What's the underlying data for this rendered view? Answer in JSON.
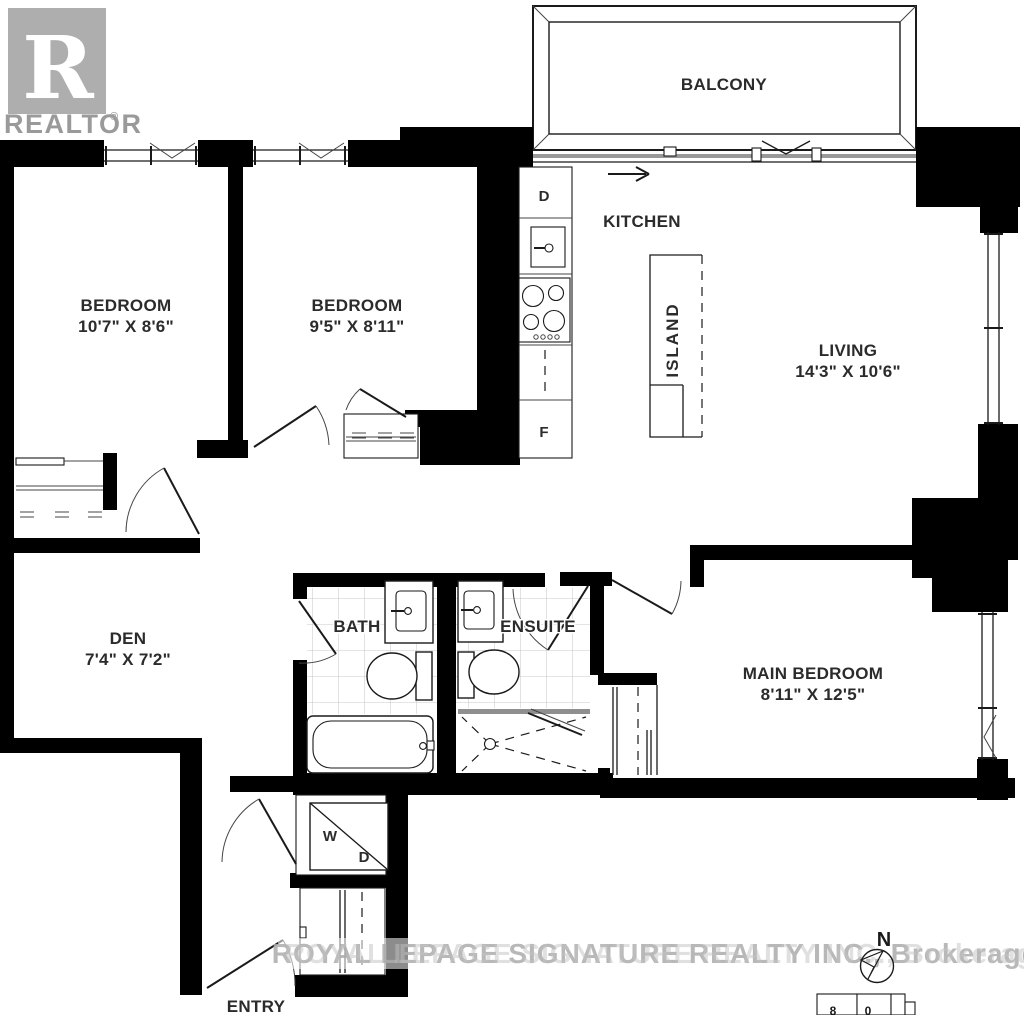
{
  "branding": {
    "realtor_logo": {
      "letter": "R",
      "label": "REALTOR",
      "registered": "®",
      "color": "#aeaeae"
    },
    "brokerage_watermark": "ROYAL LEPAGE SIGNATURE REALTY INC., Brokerage"
  },
  "rooms": {
    "balcony": {
      "name": "BALCONY"
    },
    "kitchen": {
      "name": "KITCHEN"
    },
    "island": {
      "name": "ISLAND"
    },
    "living": {
      "name": "LIVING",
      "dimensions": "14'3\" X 10'6\""
    },
    "bedroom_1": {
      "name": "BEDROOM",
      "dimensions": "10'7\" X 8'6\""
    },
    "bedroom_2": {
      "name": "BEDROOM",
      "dimensions": "9'5\" X 8'11\""
    },
    "den": {
      "name": "DEN",
      "dimensions": "7'4\" X 7'2\""
    },
    "bath": {
      "name": "BATH"
    },
    "ensuite": {
      "name": "ENSUITE"
    },
    "main_bedroom": {
      "name": "MAIN BEDROOM",
      "dimensions": "8'11\" X 12'5\""
    },
    "entry": {
      "name": "ENTRY"
    }
  },
  "appliances": {
    "dishwasher": "D",
    "fridge": "F",
    "washer": "W",
    "dryer": "D"
  },
  "compass": {
    "north": "N"
  },
  "scale_bar": {
    "digits": [
      "8",
      "0"
    ]
  },
  "colors": {
    "walls": "#000000",
    "labels": "#2b2b2b",
    "watermark": "#b3b3b3"
  }
}
